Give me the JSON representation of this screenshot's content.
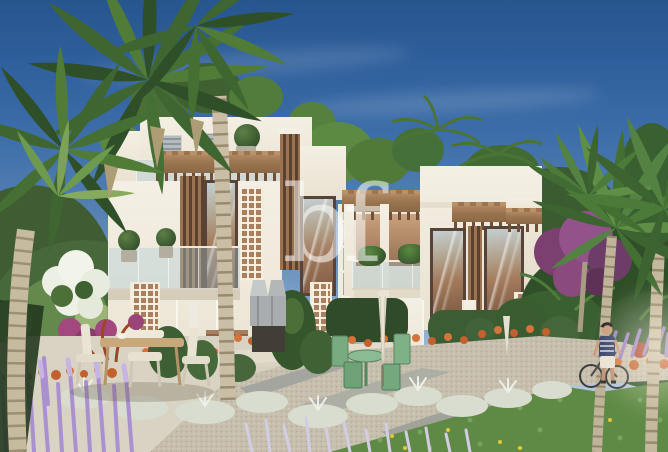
{
  "meta": {
    "title": "Townhouse exterior rendering",
    "width_px": 668,
    "height_px": 452,
    "description": "Architectural rendering of modern two-storey townhouses with wooden pergolas, slatted screens, glass balconies and mashrabiya panels, framed by palm trees and a landscaped garden path; a man stands with a bicycle at the right; clear blue sky above."
  },
  "watermark": {
    "text": "bf",
    "color": "#ffffff",
    "opacity": "0.48"
  },
  "scene_elements": [
    "sky",
    "left-fan-palm",
    "right-royal-palms",
    "townhouse-row",
    "roof-terrace",
    "pergolas",
    "wood-slat-panels",
    "mashrabiya-panels",
    "glass-balconies",
    "patio-dining-set",
    "bbq-station",
    "green-bistro-set",
    "closed-umbrellas",
    "gravel-path",
    "orange-flower-beds",
    "silver-foliage",
    "lavender-spikes",
    "lawn-groundcover",
    "bougainvillea",
    "man-with-bicycle"
  ],
  "palette": {
    "sky_top": "#27558e",
    "sky_horizon": "#cfdce4",
    "facade": "#f4efe4",
    "facade_shadow": "#e0d8c6",
    "wood": "#9a7350",
    "wood_dark": "#6f4f36",
    "glass_cool": "#c4cfd0",
    "interior_warm": "#a97c5c",
    "foliage_dark": "#2e4a2b",
    "foliage_mid": "#4d7038",
    "foliage_light": "#7da257",
    "palm_trunk": "#c6ba9f",
    "lavender": "#ab90cf",
    "orange_flower": "#c2602e",
    "silver_foliage": "#d9ddd0",
    "gravel": "#c7bfae",
    "grass": "#5f8a45",
    "bougainvillea": "#a2487e",
    "bistro_green": "#79ab81"
  }
}
